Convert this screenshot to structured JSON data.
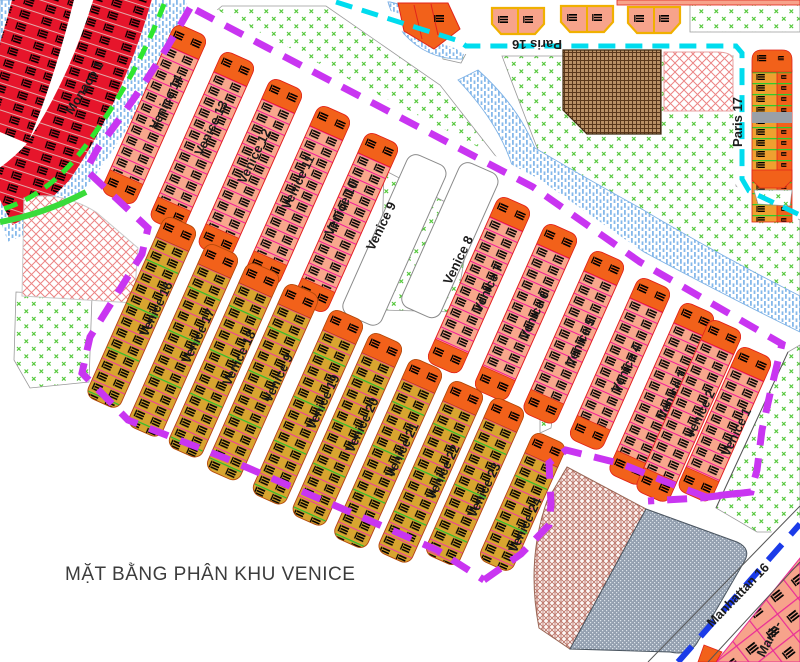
{
  "title": {
    "text": "MẶT BẰNG PHÂN KHU VENICE"
  },
  "colors": {
    "boundary_purple": "#c935f1",
    "paris_road_cyan": "#00dcee",
    "manhattan_road_blue": "#1b3be8",
    "green_line": "#2fe62f",
    "strip_orange": "#f2611a",
    "strip_salmon": "#f8a78c",
    "strip_gold": "#d8a52f",
    "monaco_red": "#e6152b",
    "grid_magenta": "#f3199b",
    "water_blue": "#86b9eb",
    "park_green": "#55c83c",
    "hatch_red": "#ec8484",
    "hatch_brown": "#59371b",
    "hatch_gray": "#94a0b0"
  },
  "map": {
    "width": 800,
    "height": 662,
    "strip_angle": 24,
    "label_angle": -64,
    "zone_labels": [
      {
        "id": "monaco-1",
        "text": "Monaco 1",
        "x": 88,
        "y": 90,
        "rot": -58,
        "size": 13
      },
      {
        "id": "paris-16",
        "text": "Paris 16",
        "x": 537,
        "y": 40,
        "rot": 180,
        "size": 12
      },
      {
        "id": "paris-17",
        "text": "Paris 17",
        "x": 742,
        "y": 122,
        "rot": -90,
        "size": 13
      },
      {
        "id": "manhattan-16",
        "text": "Manhattan 16",
        "x": 741,
        "y": 598,
        "rot": -46,
        "size": 12
      },
      {
        "id": "manhattan-partial",
        "text": "Manh-",
        "x": 773,
        "y": 641,
        "rot": -62,
        "size": 12
      }
    ],
    "strips": [
      {
        "id": "venice-14",
        "label": "Venice 14",
        "x": 192,
        "y": 30,
        "len": 185,
        "style": "pink",
        "lx": 170,
        "ly": 104
      },
      {
        "id": "venice-13",
        "label": "Venice 13",
        "x": 240,
        "y": 57,
        "len": 185,
        "style": "pink",
        "lx": 215,
        "ly": 130
      },
      {
        "id": "venice-12",
        "label": "Venice 12",
        "x": 288,
        "y": 84,
        "len": 185,
        "style": "pink",
        "lx": 258,
        "ly": 158
      },
      {
        "id": "venice-11",
        "label": "Venice 11",
        "x": 336,
        "y": 111,
        "len": 185,
        "style": "pink",
        "lx": 302,
        "ly": 184
      },
      {
        "id": "venice-10",
        "label": "Venice 10",
        "x": 384,
        "y": 138,
        "len": 185,
        "style": "pink",
        "lx": 345,
        "ly": 210
      },
      {
        "id": "venice-9",
        "label": "Venice 9",
        "x": 430,
        "y": 160,
        "len": 175,
        "style": "white",
        "lx": 385,
        "ly": 228
      },
      {
        "id": "venice-8",
        "label": "Venice 8",
        "x": 482,
        "y": 168,
        "len": 158,
        "style": "white",
        "lx": 462,
        "ly": 262
      },
      {
        "id": "venice-7",
        "label": "Venice 7",
        "x": 516,
        "y": 202,
        "len": 182,
        "style": "pink",
        "lx": 492,
        "ly": 290
      },
      {
        "id": "venice-6",
        "label": "Venice 6",
        "x": 563,
        "y": 229,
        "len": 182,
        "style": "pink",
        "lx": 538,
        "ly": 317
      },
      {
        "id": "venice-5",
        "label": "Venice 5",
        "x": 610,
        "y": 256,
        "len": 178,
        "style": "pink",
        "lx": 584,
        "ly": 344
      },
      {
        "id": "venice-4",
        "label": "Venice 4",
        "x": 656,
        "y": 283,
        "len": 177,
        "style": "pink",
        "lx": 630,
        "ly": 370
      },
      {
        "id": "venice-3",
        "label": "Venice 3",
        "x": 700,
        "y": 308,
        "len": 188,
        "style": "pink",
        "lx": 676,
        "ly": 397
      },
      {
        "id": "venice-2",
        "label": "Venice 2",
        "x": 727,
        "y": 325,
        "len": 188,
        "style": "pink",
        "lx": 704,
        "ly": 416
      },
      {
        "id": "venice-1",
        "label": "Venice 1",
        "x": 757,
        "y": 352,
        "len": 158,
        "style": "pink",
        "lx": 740,
        "ly": 434
      },
      {
        "id": "venice-16",
        "label": "Venice 16",
        "x": 182,
        "y": 222,
        "len": 198,
        "style": "gold",
        "lx": 160,
        "ly": 311
      },
      {
        "id": "venice-17",
        "label": "Venice 17",
        "x": 224,
        "y": 249,
        "len": 200,
        "style": "gold",
        "lx": 202,
        "ly": 338
      },
      {
        "id": "venice-18",
        "label": "Venice 18",
        "x": 265,
        "y": 268,
        "len": 202,
        "style": "gold",
        "lx": 243,
        "ly": 360
      },
      {
        "id": "venice-9b",
        "label": "Venice 9",
        "x": 304,
        "y": 289,
        "len": 204,
        "style": "gold",
        "lx": 282,
        "ly": 380
      },
      {
        "id": "venice-19",
        "label": "Venice 19",
        "x": 349,
        "y": 315,
        "len": 202,
        "style": "gold",
        "lx": 327,
        "ly": 404
      },
      {
        "id": "venice-20",
        "label": "Venice 20",
        "x": 388,
        "y": 338,
        "len": 200,
        "style": "gold",
        "lx": 366,
        "ly": 427
      },
      {
        "id": "venice-21",
        "label": "Venice 21",
        "x": 428,
        "y": 364,
        "len": 196,
        "style": "gold",
        "lx": 406,
        "ly": 452
      },
      {
        "id": "venice-22",
        "label": "Venice 22",
        "x": 469,
        "y": 386,
        "len": 188,
        "style": "gold",
        "lx": 447,
        "ly": 474
      },
      {
        "id": "venice-23",
        "label": "Venice 23",
        "x": 510,
        "y": 403,
        "len": 172,
        "style": "gold",
        "lx": 488,
        "ly": 492
      },
      {
        "id": "venice-24",
        "label": "Venice 24",
        "x": 551,
        "y": 438,
        "len": 140,
        "style": "gold",
        "lx": 529,
        "ly": 527
      }
    ]
  }
}
